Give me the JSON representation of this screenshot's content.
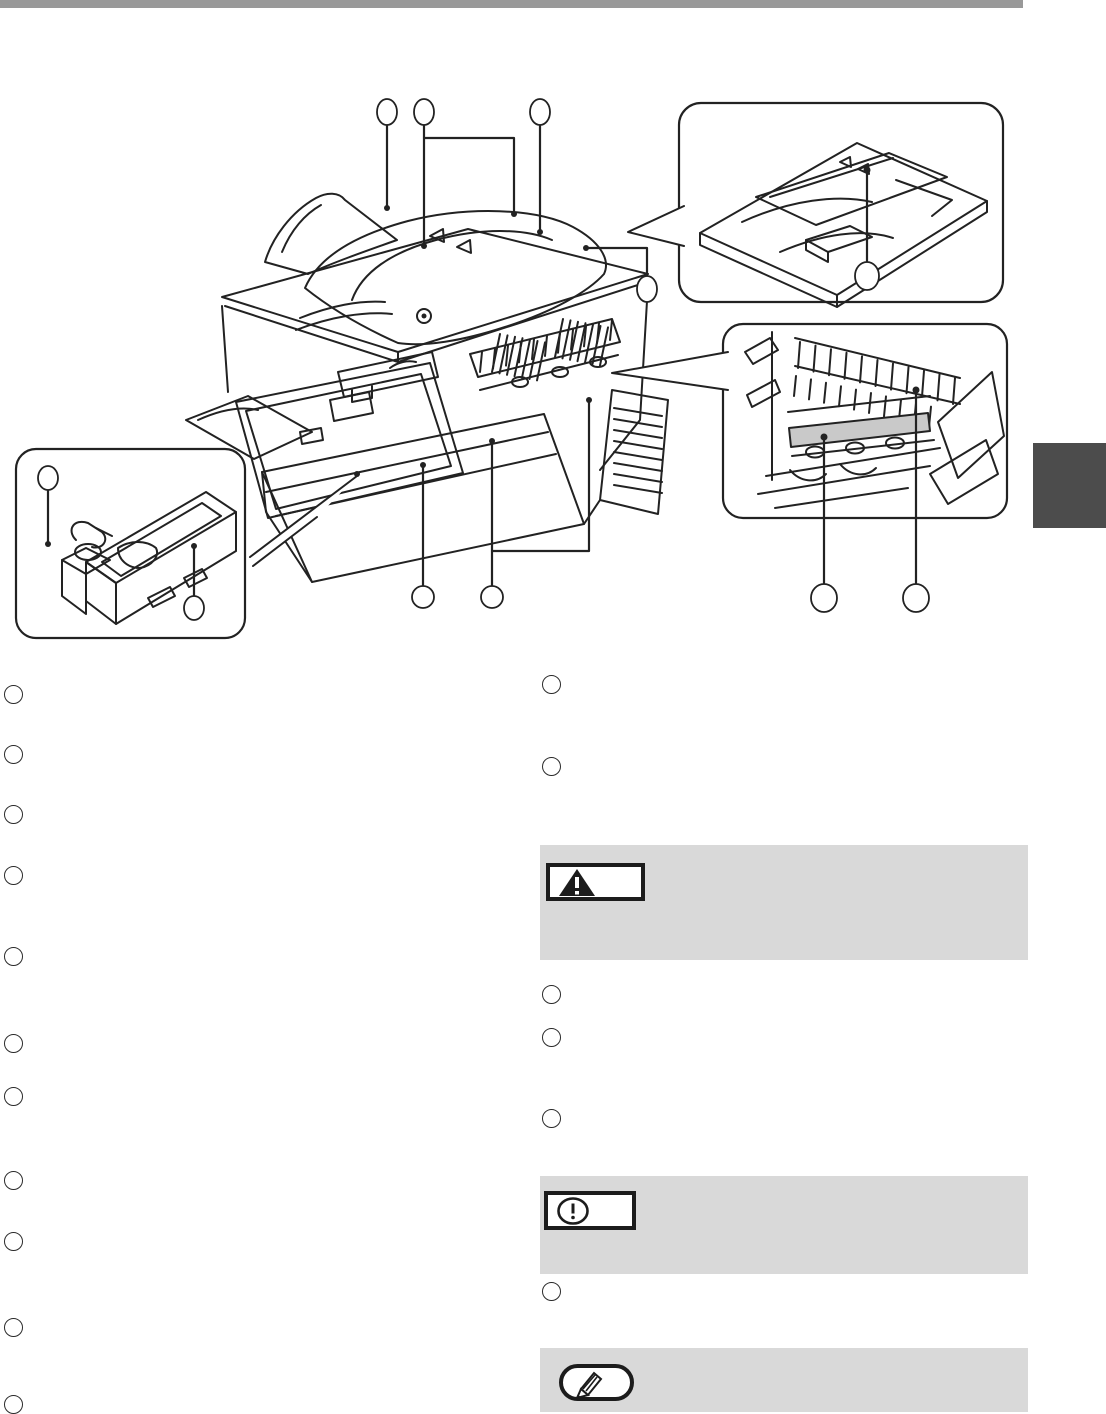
{
  "page": {
    "background": "#ffffff",
    "top_bar_color": "#999999",
    "side_tab_color": "#4c4c4c",
    "line_color": "#222222"
  },
  "diagram": {
    "callouts": {
      "top": [
        {
          "label": ""
        },
        {
          "label": ""
        },
        {
          "label": ""
        }
      ],
      "top_right": {
        "label": ""
      },
      "bottom": [
        {
          "label": ""
        },
        {
          "label": ""
        }
      ]
    },
    "insets": {
      "document_feeder": {
        "callout": {
          "label": ""
        }
      },
      "fusing_area": {
        "highlight_color": "#c9c9c9",
        "callouts": [
          {
            "label": ""
          },
          {
            "label": ""
          }
        ]
      },
      "toner_cartridge": {
        "callouts": [
          {
            "label": ""
          },
          {
            "label": ""
          }
        ]
      }
    }
  },
  "list": {
    "left_items": [
      {
        "label": ""
      },
      {
        "label": ""
      },
      {
        "label": ""
      },
      {
        "label": ""
      },
      {
        "label": ""
      },
      {
        "label": ""
      },
      {
        "label": ""
      },
      {
        "label": ""
      },
      {
        "label": ""
      },
      {
        "label": ""
      },
      {
        "label": ""
      }
    ],
    "right_items": [
      {
        "label": ""
      },
      {
        "label": ""
      },
      {
        "label": ""
      },
      {
        "label": ""
      },
      {
        "label": ""
      },
      {
        "label": ""
      }
    ]
  },
  "notices": {
    "warning": {
      "bg": "#d9d9d9",
      "icon": "warning-triangle-icon",
      "label": "",
      "body": ""
    },
    "caution": {
      "bg": "#d9d9d9",
      "icon": "exclamation-oval-icon",
      "label": "",
      "body": ""
    },
    "note": {
      "bg": "#d9d9d9",
      "icon": "pencil-icon",
      "label": "",
      "body": ""
    }
  }
}
